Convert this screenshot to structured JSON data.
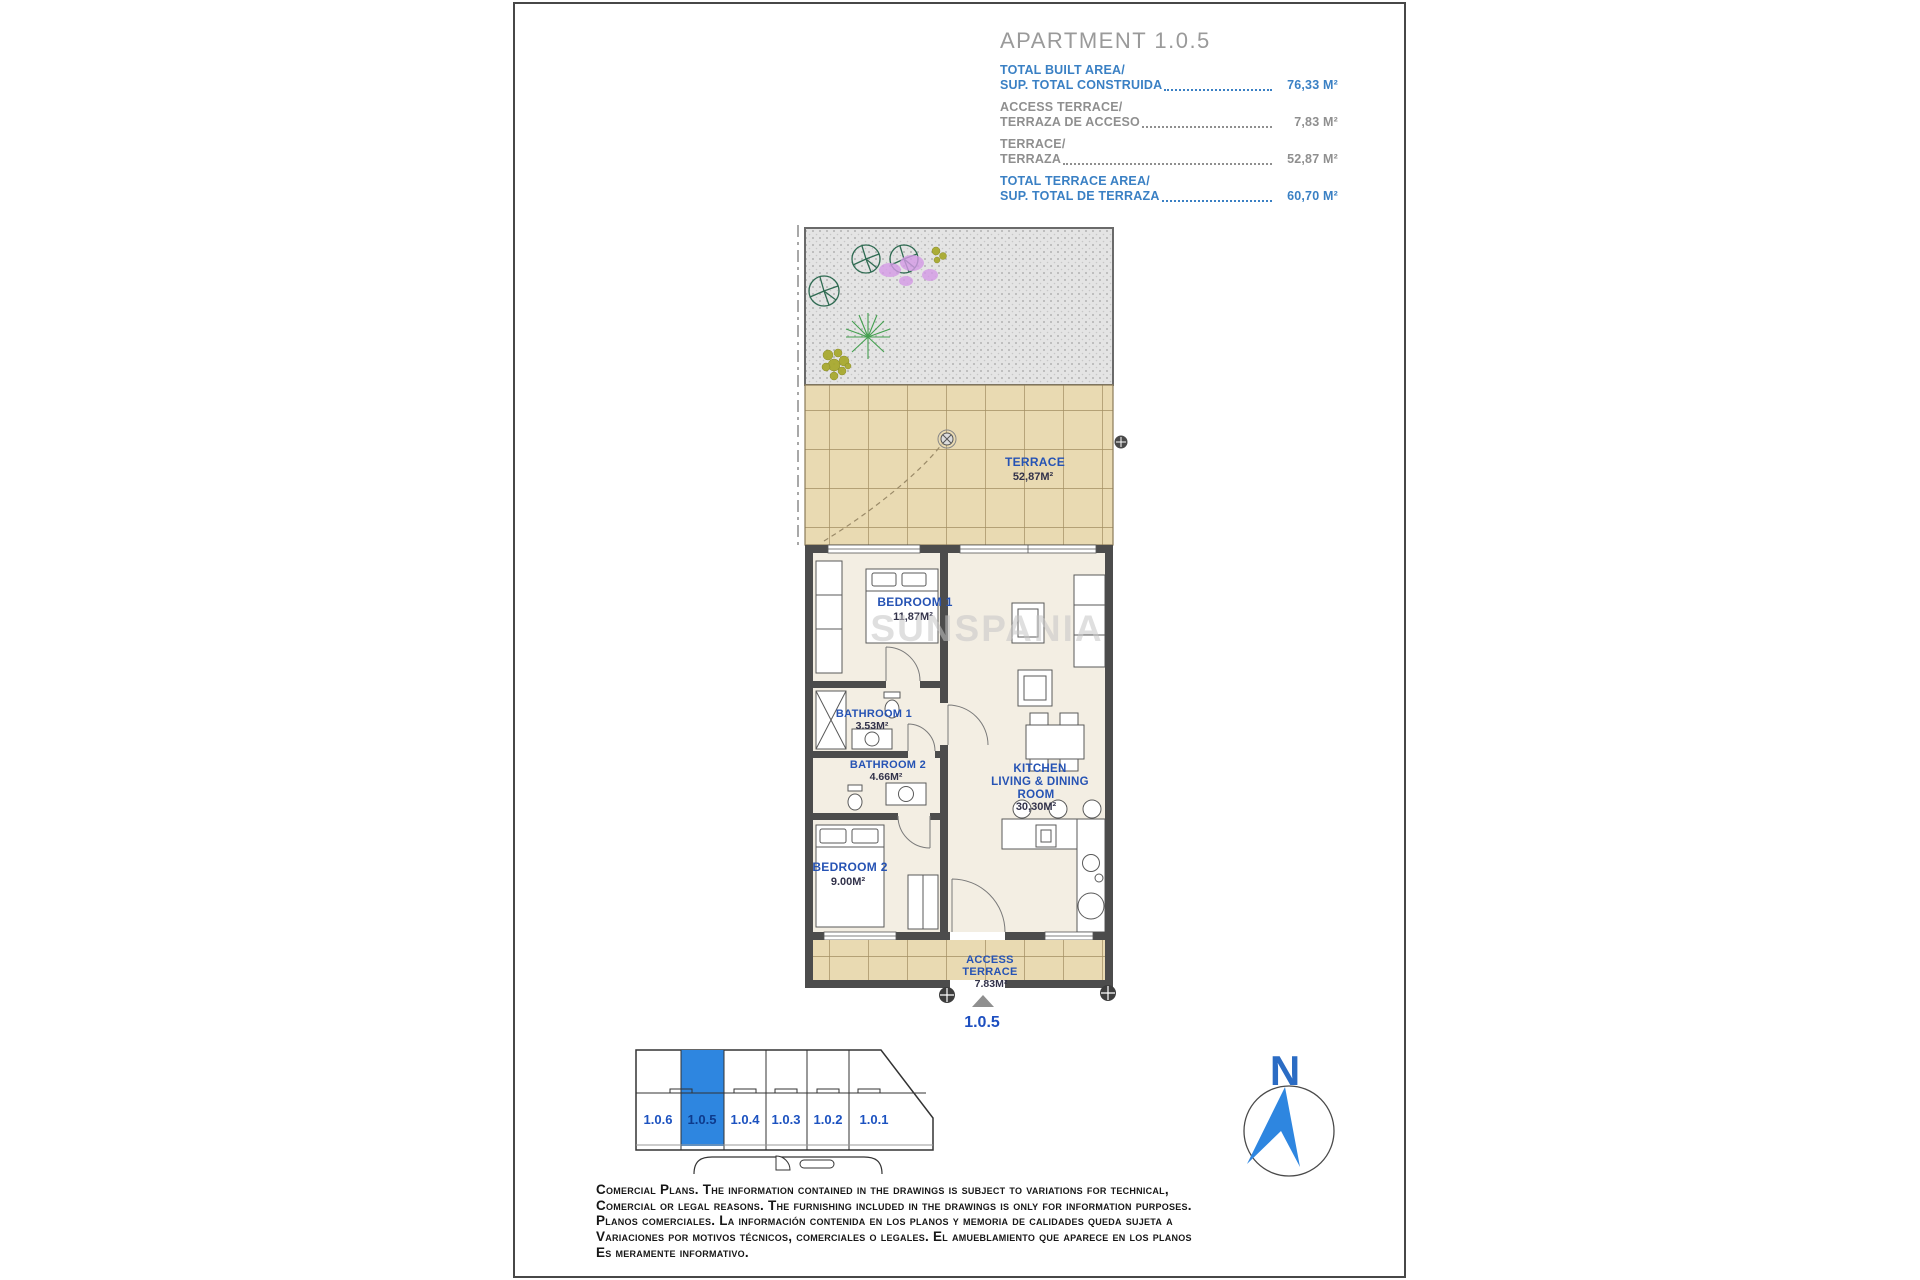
{
  "header": {
    "title": "APARTMENT 1.0.5",
    "rows": [
      {
        "line1": "TOTAL BUILT AREA/",
        "line2": "SUP. TOTAL CONSTRUIDA",
        "value": "76,33 M²"
      },
      {
        "line1": "ACCESS TERRACE/",
        "line2": "TERRAZA DE ACCESO",
        "value": "7,83 M²"
      },
      {
        "line1": "TERRACE/",
        "line2": "TERRAZA",
        "value": "52,87 M²"
      },
      {
        "line1": "TOTAL TERRACE AREA/",
        "line2": "SUP. TOTAL DE TERRAZA",
        "value": "60,70 M²"
      }
    ]
  },
  "plan": {
    "watermark": "SUNSPANIA",
    "terrace": {
      "name": "TERRACE",
      "area": "52,87M²"
    },
    "bedroom1": {
      "name": "BEDROOM 1",
      "area": "11,87M²"
    },
    "bathroom1": {
      "name": "BATHROOM 1",
      "area": "3.53M²"
    },
    "bathroom2": {
      "name": "BATHROOM 2",
      "area": "4.66M²"
    },
    "bedroom2": {
      "name": "BEDROOM 2",
      "area": "9.00M²"
    },
    "kitchen": {
      "line1": "KITCHEN",
      "line2": "LIVING & DINING",
      "line3": "ROOM",
      "area": "30,30M²"
    },
    "access": {
      "line1": "ACCESS",
      "line2": "TERRACE",
      "area": "7.83M²"
    },
    "unit_marker": "1.0.5"
  },
  "key_plan": {
    "units": [
      {
        "label": "1.0.6",
        "highlighted": false
      },
      {
        "label": "1.0.5",
        "highlighted": true
      },
      {
        "label": "1.0.4",
        "highlighted": false
      },
      {
        "label": "1.0.3",
        "highlighted": false
      },
      {
        "label": "1.0.2",
        "highlighted": false
      },
      {
        "label": "1.0.1",
        "highlighted": false
      }
    ]
  },
  "compass": {
    "north_label": "N"
  },
  "disclaimer": {
    "lines": [
      "Comercial Plans. The information contained in the drawings is subject to variations for technical,",
      "Comercial or legal reasons. The furnishing included in the drawings is only for information purposes.",
      "Planos comerciales. La información contenida en los planos y memoria de calidades queda sujeta a",
      "Variaciones por motivos técnicos, comerciales o legales. El amueblamiento que aparece en los planos",
      "Es meramente informativo."
    ]
  },
  "colors": {
    "accent_blue": "#2e86e0",
    "room_label_blue": "#2653b4",
    "header_blue": "#3a80c4",
    "header_gray": "#8f8f8f",
    "title_gray": "#9a9a9a",
    "wall_gray": "#4c4c4c",
    "terrace_tile": "#e9dab2",
    "interior_floor": "#f3eee3",
    "garden_gravel": "#e4e4e4"
  }
}
